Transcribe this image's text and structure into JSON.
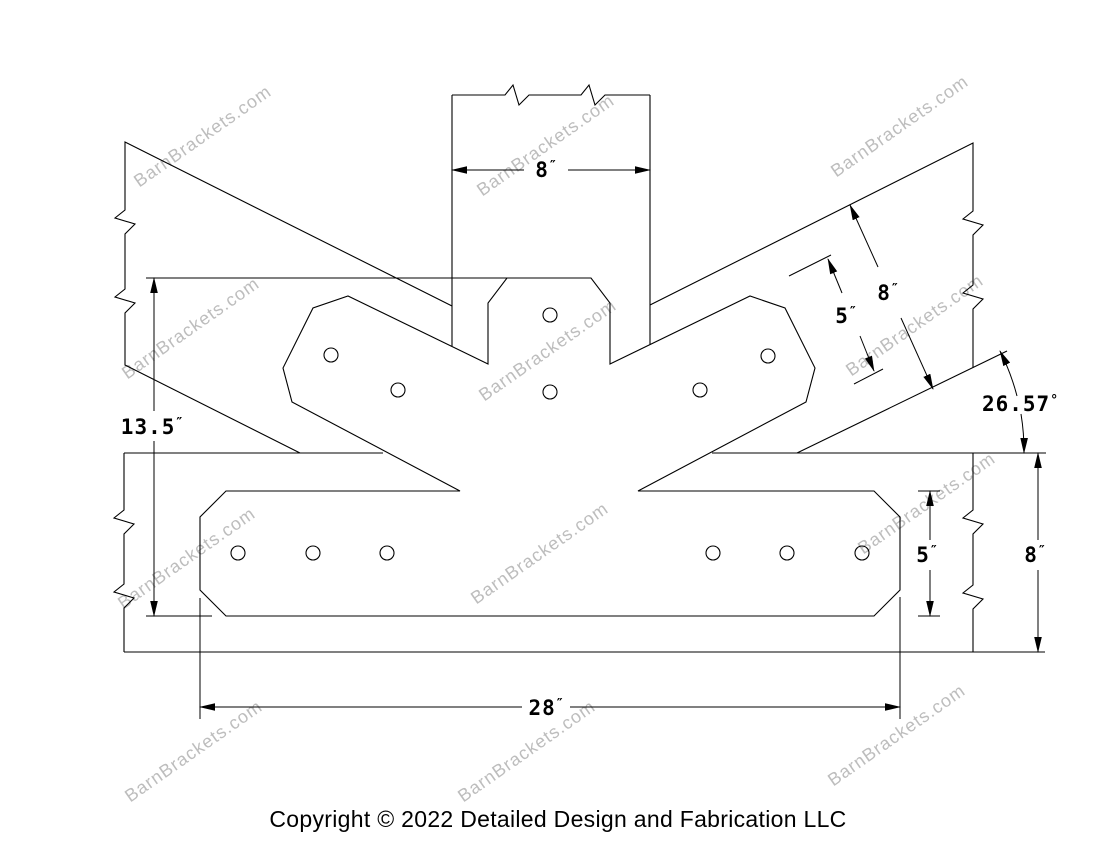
{
  "drawing": {
    "background_color": "#ffffff",
    "line_color": "#000000",
    "watermark": {
      "text": "BarnBrackets.com",
      "color": "#bdbdbd"
    },
    "copyright": "Copyright © 2022 Detailed Design and Fabrication LLC",
    "dimensions": {
      "post_width": {
        "value": "8",
        "unit": "″"
      },
      "truss_height": {
        "value": "13.5",
        "unit": "″"
      },
      "arm_width": {
        "value": "5",
        "unit": "″"
      },
      "rafter_width": {
        "value": "8",
        "unit": "″"
      },
      "rafter_angle": {
        "value": "26.57",
        "unit": "°"
      },
      "plate_height": {
        "value": "5",
        "unit": "″"
      },
      "beam_height": {
        "value": "8",
        "unit": "″"
      },
      "plate_width": {
        "value": "28",
        "unit": "″"
      }
    }
  }
}
